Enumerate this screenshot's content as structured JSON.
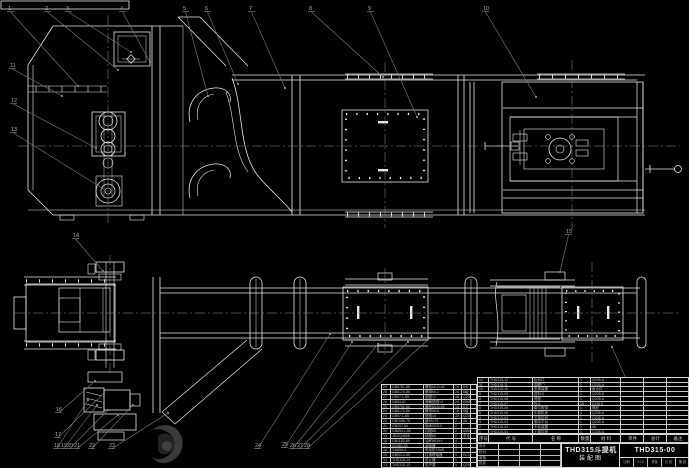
{
  "drawing": {
    "type": "CAD assembly drawing, bucket elevator, white lines on black",
    "views": [
      "side elevation (top)",
      "plan view (bottom)"
    ]
  },
  "title_block": {
    "product": "THD315斗提机",
    "doc_type": "装配图",
    "drawing_no": "THD315-00",
    "strip_cells": [
      "比例",
      "1:10",
      "重量",
      "共 张",
      "第 张"
    ],
    "signature_rows": [
      [
        "设计",
        "",
        "",
        ""
      ],
      [
        "校对",
        "",
        "",
        ""
      ],
      [
        "审核",
        "",
        "",
        ""
      ],
      [
        "批准",
        "",
        "",
        ""
      ]
    ]
  },
  "bom_header": {
    "cells": [
      "序号",
      "代  号",
      "名  称",
      "数量",
      "材  料",
      "单件",
      "总计",
      "备注"
    ]
  },
  "bom_right": {
    "rows": [
      [
        "12",
        "THD315-12",
        "出料口",
        "1",
        "Q235-A",
        "",
        "",
        ""
      ],
      [
        "11",
        "THD315-11",
        "观察门",
        "1",
        "Q235-A",
        "",
        "",
        ""
      ],
      [
        "10",
        "THD315-10",
        "张紧装置",
        "1",
        "组合件",
        "",
        "",
        ""
      ],
      [
        "9",
        "THD315-09",
        "进料斗",
        "1",
        "Q235-A",
        "",
        "",
        ""
      ],
      [
        "8",
        "THD315-08",
        "底座",
        "1",
        "Q235-A",
        "",
        "",
        ""
      ],
      [
        "7",
        "THD315-07",
        "料斗",
        "38",
        "DX51D",
        "",
        "",
        ""
      ],
      [
        "6",
        "THD315-06",
        "牵引胶带",
        "1",
        "橡胶",
        "",
        "",
        ""
      ],
      [
        "5",
        "THD315-05",
        "中部机壳",
        "4",
        "Q235-A",
        "",
        "",
        ""
      ],
      [
        "4",
        "THD315-04",
        "下部区段",
        "1",
        "Q235-A",
        "",
        "",
        ""
      ],
      [
        "3",
        "THD315-03",
        "驱动平台",
        "1",
        "Q235-A",
        "",
        "",
        ""
      ],
      [
        "2",
        "THD315-02",
        "头轮装置",
        "1",
        "45",
        "",
        "",
        ""
      ],
      [
        "1",
        "THD315-01",
        "上部区段",
        "1",
        "Q235-A",
        "",
        "",
        ""
      ]
    ]
  },
  "bom_left": {
    "rows": [
      [
        "29",
        "GB5782-86",
        "螺栓M12×40",
        "24",
        "8.8",
        ""
      ],
      [
        "28",
        "GB6170-86",
        "螺母M12",
        "24",
        "8级",
        ""
      ],
      [
        "27",
        "GB97.1-85",
        "垫圈12",
        "48",
        "Q235",
        ""
      ],
      [
        "26",
        "GB93-87",
        "弹簧垫圈12",
        "24",
        "65Mn",
        ""
      ],
      [
        "25",
        "GB5782-86",
        "螺栓M16×55",
        "16",
        "8.8",
        ""
      ],
      [
        "24",
        "GB6170-86",
        "螺母M16",
        "16",
        "8级",
        ""
      ],
      [
        "23",
        "GB97.1-85",
        "垫圈16",
        "32",
        "Q235",
        ""
      ],
      [
        "22",
        "GB1096-79",
        "键18×70",
        "2",
        "45",
        ""
      ],
      [
        "21",
        "GB297-84",
        "轴承30212",
        "2",
        "",
        ""
      ],
      [
        "20",
        "GB894.1-86",
        "挡圈55",
        "2",
        "65Mn",
        ""
      ],
      [
        "19",
        "JB/ZQ4606",
        "毡圈60",
        "2",
        "羊毛毡",
        ""
      ],
      [
        "18",
        "GB1152-89",
        "油杯M10×1",
        "4",
        "",
        ""
      ],
      [
        "17",
        "ZQ350-50",
        "减速器",
        "1",
        "",
        ""
      ],
      [
        "16",
        "Y160M-4",
        "电动机11kW",
        "1",
        "",
        ""
      ],
      [
        "15",
        "GB5014-85",
        "柱销联轴器",
        "1",
        "HL3",
        ""
      ],
      [
        "14",
        "THD315-14",
        "逆止器",
        "1",
        "",
        ""
      ],
      [
        "13",
        "THD315-13",
        "防护罩",
        "1",
        "Q235-A",
        ""
      ]
    ]
  },
  "callouts": [
    {
      "label": "1",
      "x": 8,
      "y": 10,
      "tx": 78,
      "ty": 86
    },
    {
      "label": "2",
      "x": 45,
      "y": 10,
      "tx": 118,
      "ty": 70
    },
    {
      "label": "3",
      "x": 66,
      "y": 10,
      "tx": 131,
      "ty": 52
    },
    {
      "label": "4",
      "x": 120,
      "y": 10,
      "tx": 150,
      "ty": 62
    },
    {
      "label": "5",
      "x": 183,
      "y": 10,
      "tx": 208,
      "ty": 96
    },
    {
      "label": "6",
      "x": 205,
      "y": 10,
      "tx": 238,
      "ty": 84
    },
    {
      "label": "7",
      "x": 249,
      "y": 10,
      "tx": 285,
      "ty": 88
    },
    {
      "label": "8",
      "x": 309,
      "y": 10,
      "tx": 383,
      "ty": 77
    },
    {
      "label": "9",
      "x": 368,
      "y": 10,
      "tx": 417,
      "ty": 117
    },
    {
      "label": "10",
      "x": 483,
      "y": 10,
      "tx": 536,
      "ty": 97
    },
    {
      "label": "11",
      "x": 10,
      "y": 67,
      "tx": 62,
      "ty": 96
    },
    {
      "label": "12",
      "x": 11,
      "y": 102,
      "tx": 96,
      "ty": 148
    },
    {
      "label": "13",
      "x": 11,
      "y": 131,
      "tx": 102,
      "ty": 188
    },
    {
      "label": "14",
      "x": 73,
      "y": 237,
      "tx": 103,
      "ty": 271
    },
    {
      "label": "15",
      "x": 566,
      "y": 233,
      "tx": 560,
      "ty": 272
    },
    {
      "label": "16",
      "x": 56,
      "y": 411,
      "tx": 95,
      "ty": 381
    },
    {
      "label": "17",
      "x": 55,
      "y": 436,
      "tx": 104,
      "ty": 393
    },
    {
      "label": "18",
      "x": 54,
      "y": 447,
      "tx": 88,
      "ty": 400
    },
    {
      "label": "19",
      "x": 61,
      "y": 447,
      "tx": 97,
      "ty": 405
    },
    {
      "label": "20",
      "x": 67,
      "y": 447,
      "tx": 108,
      "ty": 410
    },
    {
      "label": "21",
      "x": 74,
      "y": 447,
      "tx": 118,
      "ty": 415
    },
    {
      "label": "22",
      "x": 89,
      "y": 447,
      "tx": 133,
      "ty": 405
    },
    {
      "label": "23",
      "x": 109,
      "y": 447,
      "tx": 168,
      "ty": 413
    },
    {
      "label": "24",
      "x": 255,
      "y": 447,
      "tx": 330,
      "ty": 334
    },
    {
      "label": "25",
      "x": 282,
      "y": 446,
      "tx": 352,
      "ty": 342
    },
    {
      "label": "26",
      "x": 290,
      "y": 447,
      "tx": 378,
      "ty": 344
    },
    {
      "label": "27",
      "x": 297,
      "y": 447,
      "tx": 408,
      "ty": 342
    },
    {
      "label": "28",
      "x": 304,
      "y": 447,
      "tx": 430,
      "ty": 338
    },
    {
      "label": "29",
      "x": 654,
      "y": 446,
      "tx": 612,
      "ty": 347
    }
  ],
  "colors": {
    "background": "#000000",
    "line": "#e8e8e8",
    "leader": "#7d7d7d",
    "centerline": "#8f8f8f",
    "callout_text": "#a8a8a8"
  }
}
